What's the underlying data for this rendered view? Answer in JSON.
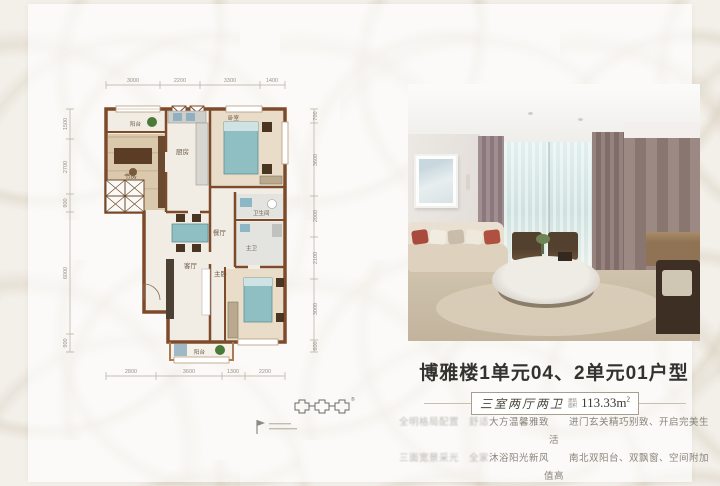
{
  "floorplan": {
    "dims_top": [
      "3000",
      "2200",
      "3300",
      "1400"
    ],
    "dims_bottom": [
      "2800",
      "3600",
      "1300",
      "2200"
    ],
    "dims_left": [
      "1500",
      "2700",
      "900",
      "6000",
      "900"
    ],
    "dims_right": [
      "700",
      "3600",
      "2000",
      "2100",
      "3000",
      "600"
    ],
    "labels": {
      "balcony_top": "阳台",
      "study": "书房",
      "kitchen": "厨房",
      "bedroom": "卧室",
      "bath": "卫生间",
      "dining": "餐厅",
      "living": "客厅",
      "master": "主卧",
      "master_bath": "主卫",
      "balcony_bottom": "阳台"
    },
    "colors": {
      "wall": "#7d4a2a",
      "teal": "#8fbfc2",
      "wood": "#dbc9ad"
    }
  },
  "brand": {
    "registered_mark": "®"
  },
  "info": {
    "title": "博雅楼1单元04、2单元01户型",
    "badge": {
      "rooms_text": "三室两厅两卫",
      "area_label_line1": "建筑",
      "area_label_line2": "面积",
      "area_value": "113.33m",
      "area_unit_sup": "2"
    },
    "desc": {
      "l1_blur": "全明格局配置　舒适",
      "l1_clear": "大方温馨雅致　　进门玄关精巧别致、开启完美生活",
      "l2_blur": "三面宽景采光　全家",
      "l2_clear": "沐浴阳光新风　　南北双阳台、双飘窗、空间附加值高"
    }
  }
}
